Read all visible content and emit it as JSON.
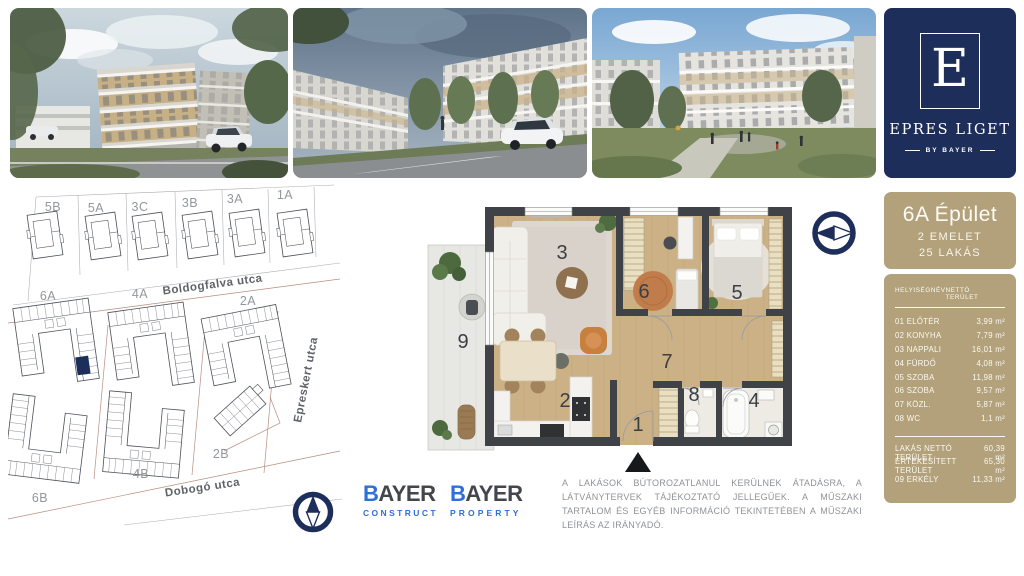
{
  "brand": {
    "logo_letter": "E",
    "name": "EPRES LIGET",
    "byline": "BY BAYER",
    "navy": "#1c2e59",
    "tan": "#b2a17a"
  },
  "site_plan": {
    "top_buildings": [
      "5B",
      "5A",
      "3C",
      "3B",
      "3A",
      "1A"
    ],
    "mid_buildings": [
      "6A",
      "4A",
      "2A"
    ],
    "bottom_buildings": [
      "6B",
      "4B",
      "2B"
    ],
    "streets": {
      "north": "Boldogfalva utca",
      "east": "Epreskert utca",
      "south": "Dobogó utca"
    },
    "highlighted_building": "6A"
  },
  "floor_plan": {
    "room_labels": [
      "1",
      "2",
      "3",
      "4",
      "5",
      "6",
      "7",
      "8",
      "9"
    ]
  },
  "unit_info": {
    "title": "6A Épület",
    "subtitle_floor": "2 EMELET",
    "subtitle_units": "25 LAKÁS",
    "table": {
      "columns": {
        "name": "HELYISÉGNÉV",
        "area": "NETTÓ TERÜLET"
      },
      "rows": [
        {
          "name": "01 ELŐTÉR",
          "area": "3,99 m²"
        },
        {
          "name": "02 KONYHA",
          "area": "7,79 m²"
        },
        {
          "name": "03 NAPPALI",
          "area": "16,01 m²"
        },
        {
          "name": "04 FÜRDŐ",
          "area": "4,08 m²"
        },
        {
          "name": "05 SZOBA",
          "area": "11,98 m²"
        },
        {
          "name": "06 SZOBA",
          "area": "9,57 m²"
        },
        {
          "name": "07 KÖZL.",
          "area": "5,87 m²"
        },
        {
          "name": "08 WC",
          "area": "1,1 m²"
        }
      ],
      "summary": [
        {
          "name": "LAKÁS NETTÓ TERÜLET",
          "area": "60,39 m²"
        },
        {
          "name": "ÉRTÉKESÍTETT TERÜLET",
          "area": "65,30 m²"
        },
        {
          "name": "09 ERKÉLY",
          "area": "11,33 m²"
        }
      ]
    }
  },
  "logos": {
    "construct": {
      "brand_b": "B",
      "brand_rest": "AYER",
      "division": "CONSTRUCT"
    },
    "property": {
      "brand_b": "B",
      "brand_rest": "AYER",
      "division": "PROPERTY"
    }
  },
  "disclaimer": "A LAKÁSOK BÚTOROZATLANUL KERÜLNEK ÁTADÁSRA, A LÁTVÁNYTERVEK TÁJÉKOZTATÓ JELLEGŰEK. A MŰSZAKI TARTALOM ÉS EGYÉB INFORMÁCIÓ TEKINTETÉBEN A MŰSZAKI LEÍRÁS AZ IRÁNYADÓ."
}
